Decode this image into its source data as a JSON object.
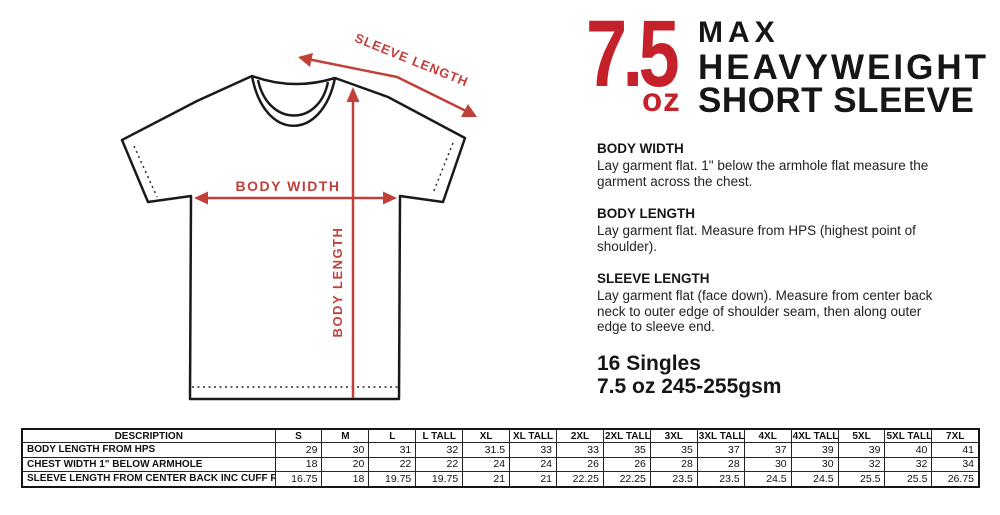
{
  "colors": {
    "title_red": "#c5212a",
    "diagram_red": "#c2403a",
    "ink": "#111111"
  },
  "title": {
    "weight_value": "7.5",
    "weight_unit": "oz",
    "line1": "MAX",
    "line2": "HEAVYWEIGHT",
    "line3": "SHORT SLEEVE"
  },
  "diagram": {
    "labels": {
      "sleeve_length": "SLEEVE LENGTH",
      "body_width": "BODY WIDTH",
      "body_length": "BODY LENGTH"
    }
  },
  "specs": [
    {
      "heading": "BODY WIDTH",
      "body": "Lay garment flat. 1\" below the armhole flat measure the\ngarment across the chest."
    },
    {
      "heading": "BODY LENGTH",
      "body": "Lay garment flat. Measure from HPS (highest point of\nshoulder)."
    },
    {
      "heading": "SLEEVE LENGTH",
      "body": "Lay garment flat (face down). Measure from center back\nneck to outer edge of shoulder seam, then along outer\nedge to sleeve end."
    }
  ],
  "fabric": {
    "line1": "16 Singles",
    "line2": "7.5 oz 245-255gsm"
  },
  "table": {
    "headers": [
      "DESCRIPTION",
      "S",
      "M",
      "L",
      "L TALL",
      "XL",
      "XL TALL",
      "2XL",
      "2XL TALL",
      "3XL",
      "3XL TALL",
      "4XL",
      "4XL TALL",
      "5XL",
      "5XL TALL",
      "7XL"
    ],
    "rows": [
      {
        "label": "BODY LENGTH FROM HPS",
        "values": [
          "29",
          "30",
          "31",
          "32",
          "31.5",
          "33",
          "33",
          "35",
          "35",
          "37",
          "37",
          "39",
          "39",
          "40",
          "41"
        ]
      },
      {
        "label": "CHEST WIDTH 1\" BELOW ARMHOLE",
        "values": [
          "18",
          "20",
          "22",
          "22",
          "24",
          "24",
          "26",
          "26",
          "28",
          "28",
          "30",
          "30",
          "32",
          "32",
          "34"
        ]
      },
      {
        "label": "SLEEVE LENGTH FROM CENTER BACK INC CUFF RIB",
        "values": [
          "16.75",
          "18",
          "19.75",
          "19.75",
          "21",
          "21",
          "22.25",
          "22.25",
          "23.5",
          "23.5",
          "24.5",
          "24.5",
          "25.5",
          "25.5",
          "26.75"
        ]
      }
    ]
  }
}
